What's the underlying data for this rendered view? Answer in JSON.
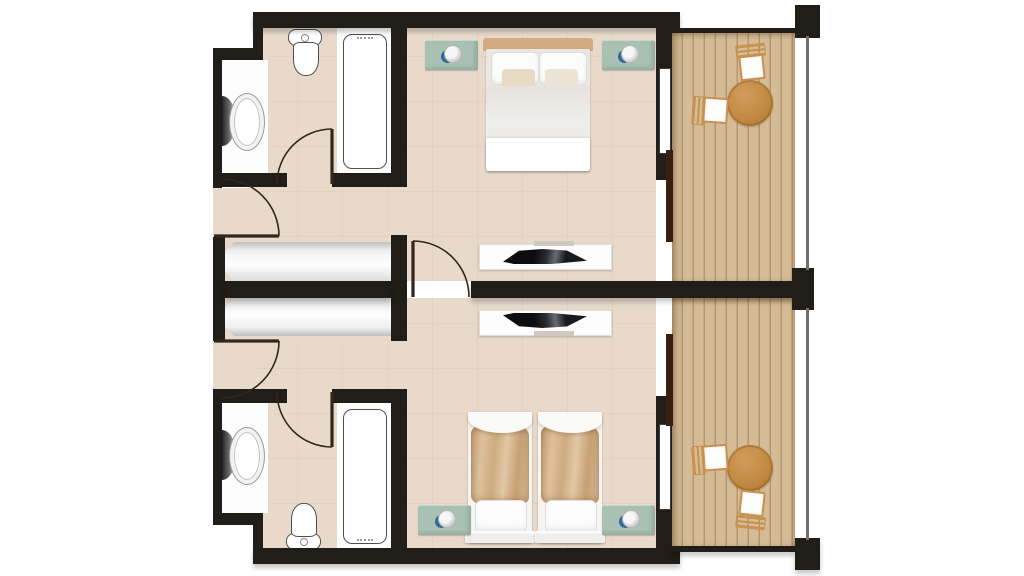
{
  "plan": {
    "label": "Floor plan - two mirrored hotel guest rooms with bathrooms and balconies",
    "units": [
      {
        "name": "guest-room-top",
        "bedroom": [
          "double-bed",
          "headboard",
          "pillows",
          "accent-pillows",
          "nightstand-left",
          "nightstand-right",
          "table-lamp-left",
          "table-lamp-right",
          "wardrobe",
          "tv-console",
          "flat-screen-tv"
        ],
        "bathroom": [
          "bathtub",
          "washbasin",
          "toilet"
        ],
        "balcony": [
          "wood-deck",
          "round-table",
          "chair-upper",
          "chair-left",
          "railing"
        ],
        "doors": [
          "entry-door",
          "bathroom-door",
          "connecting-door",
          "sliding-glass-door"
        ]
      },
      {
        "name": "guest-room-bottom",
        "bedroom": [
          "twin-bed-left",
          "twin-bed-right",
          "nightstand-left",
          "nightstand-right",
          "table-lamp-left",
          "table-lamp-right",
          "wardrobe",
          "tv-console",
          "flat-screen-tv"
        ],
        "bathroom": [
          "bathtub",
          "washbasin",
          "toilet"
        ],
        "balcony": [
          "wood-deck",
          "round-table",
          "chair-left",
          "chair-lower",
          "railing"
        ],
        "doors": [
          "entry-door",
          "bathroom-door",
          "connecting-door",
          "sliding-glass-door"
        ]
      }
    ]
  },
  "colors": {
    "wall": "#211d19",
    "floor": "#e8d9ca",
    "floor_line": "rgba(155,115,85,0.07)",
    "white_area": "#fdfdfd",
    "deck": "#d5bb96",
    "deck_line": "#b5976f",
    "wood": "#c8914e",
    "sage": "#a8c1b3",
    "lamp_blue": "#2e6d99",
    "headboard": "#d3ab83",
    "blanket": "#d2af88",
    "duvet": "#efede9",
    "mattress": "#eae7e2",
    "pillow": "#fcfcfc",
    "accent_a": "#e7dac3",
    "accent_b": "#ede4d5",
    "closet_hi": "#ffffff",
    "closet_lo": "#bfbfbf",
    "fixture": "#4f4f4f",
    "door_line": "#33261c",
    "glass": "#3a1e12",
    "rail": "#707070"
  }
}
